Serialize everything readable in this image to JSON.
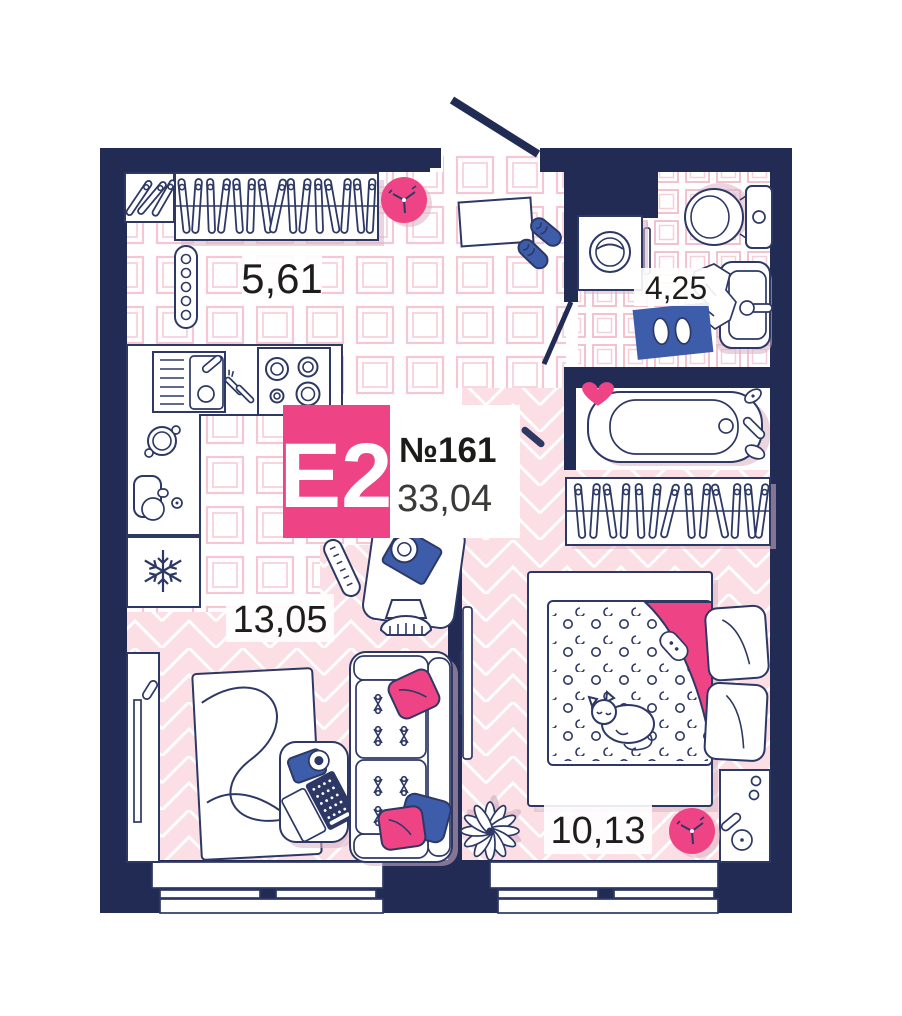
{
  "floor_plan": {
    "badge": {
      "type": "Е2",
      "number": "№161",
      "total_area": "33,04"
    },
    "rooms": {
      "hallway": {
        "area": "5,61"
      },
      "bathroom": {
        "area": "4,25"
      },
      "living": {
        "area": "13,05"
      },
      "bedroom": {
        "area": "10,13"
      }
    },
    "colors": {
      "wall": "#222b54",
      "outline": "#2d3865",
      "accent_pink": "#ee4486",
      "accent_blue": "#3d5dab",
      "floor_pink": "#fbdfe5",
      "tile_line_hall": "#f6c7d3",
      "tile_line_bath": "#f3bcca",
      "shadow": "#d9b2c4",
      "label_text": "#1d1d1b"
    },
    "furniture_icons": [
      "coat-rack-icon",
      "wardrobe-hangers-icon",
      "ceiling-fan-icon",
      "radiator-icon",
      "doormat-icon",
      "sneakers-icon",
      "washing-machine-icon",
      "toilet-icon",
      "sink-icon",
      "towel-icon",
      "bath-mat-icon",
      "slippers-icon",
      "bathtub-icon",
      "heart-icon",
      "kitchen-sink-icon",
      "stove-icon",
      "pot-icon",
      "mixer-icon",
      "fridge-snowflake-icon",
      "cutlery-icon",
      "desk-icon",
      "camera-icon",
      "desk-chair-icon",
      "tv-console-icon",
      "tv-icon",
      "remote-icon",
      "rug-icon",
      "coffee-table-icon",
      "laptop-icon",
      "sofa-icon",
      "pillow-icon",
      "bed-icon",
      "blanket-icon",
      "cat-icon",
      "nightstand-icon",
      "lamp-icon",
      "plant-icon",
      "wall-clock-icon",
      "door-swing-icon",
      "window-icon"
    ]
  }
}
